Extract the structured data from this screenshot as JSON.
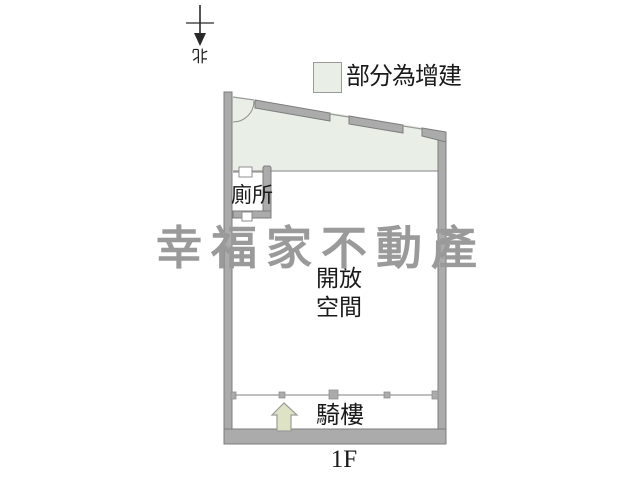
{
  "title": "1F floor plan",
  "compass": {
    "label": "北"
  },
  "legend": {
    "extension_label": "部分為增建"
  },
  "plan": {
    "toilet_label": "廁所",
    "open_space_label": "開放\n空間",
    "arcade_label": "騎樓",
    "floor_label": "1F"
  },
  "watermark": {
    "text": "幸福家不動產"
  },
  "colors": {
    "extension_fill": "#e9efe6",
    "wall_fill": "#ababab",
    "wall_edge": "#7d7d7d",
    "line": "#999999",
    "arrow_fill": "#dfe3c6",
    "watermark": "#9a9a9a"
  }
}
